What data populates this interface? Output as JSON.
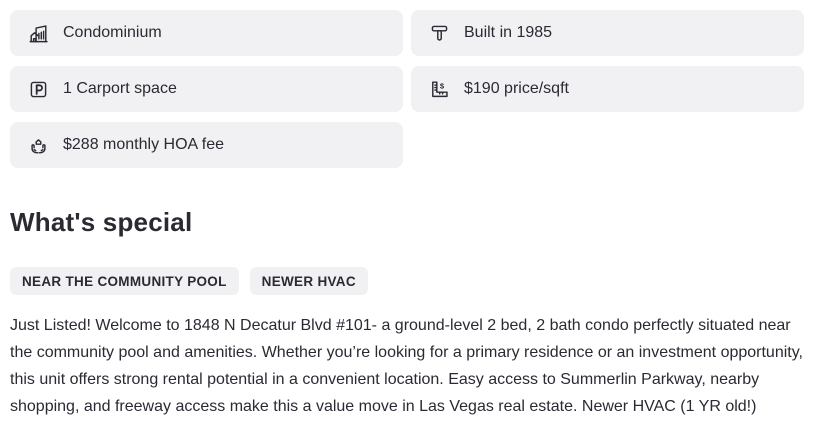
{
  "theme": {
    "page_bg": "#ffffff",
    "card_bg": "#f1f1f4",
    "text_color": "#2a2a33"
  },
  "facts": {
    "items": [
      {
        "icon": "building-icon",
        "label": "Condominium"
      },
      {
        "icon": "hammer-icon",
        "label": "Built in 1985"
      },
      {
        "icon": "parking-icon",
        "label": "1 Carport space"
      },
      {
        "icon": "ruler-dollar-icon",
        "label": "$190 price/sqft"
      },
      {
        "icon": "hands-house-icon",
        "label": "$288 monthly HOA fee"
      }
    ]
  },
  "whats_special": {
    "title": "What's special",
    "tags": [
      "NEAR THE COMMUNITY POOL",
      "NEWER HVAC"
    ],
    "description": "Just Listed! Welcome to 1848 N Decatur Blvd #101- a ground-level 2 bed, 2 bath condo perfectly situated near the community pool and amenities. Whether you’re looking for a primary residence or an investment opportunity, this unit offers strong rental potential in a convenient location. Easy access to Summerlin Parkway, nearby shopping, and freeway access make this a value move in Las Vegas real estate. Newer HVAC (1 YR old!)"
  }
}
